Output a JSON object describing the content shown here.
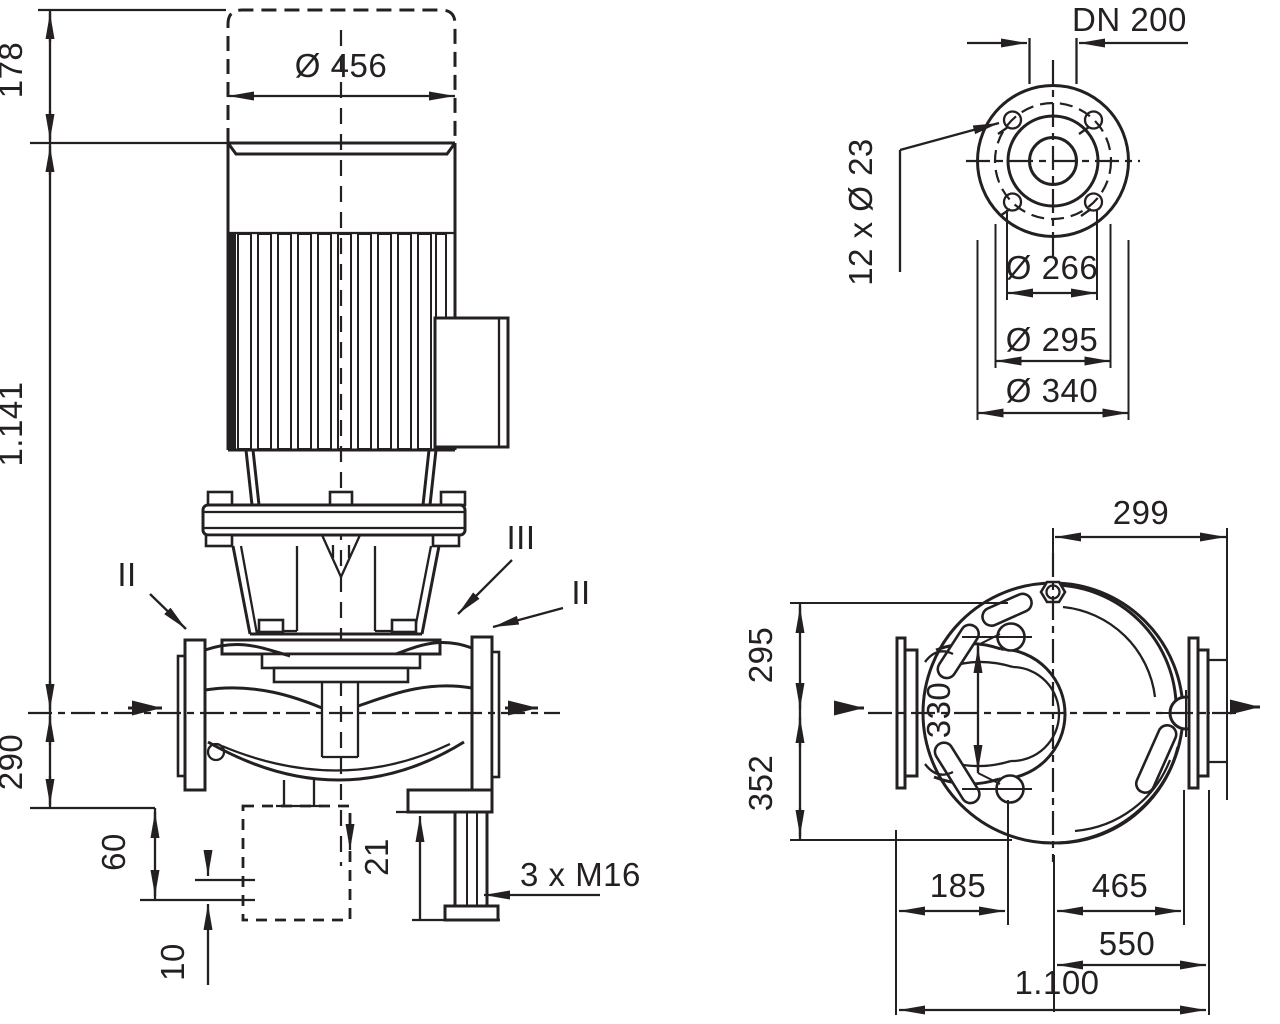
{
  "colors": {
    "background": "#ffffff",
    "ink": "#242021"
  },
  "front_view": {
    "dims": {
      "envelope_height": "178",
      "motor_diameter": "Ø 456",
      "total_height": "1.141",
      "centerline_height": "290",
      "foot_height": "60",
      "base_height": "10",
      "pad_height": "21",
      "foot_thread": "3 x M16"
    },
    "sections": {
      "left": "II",
      "top": "III",
      "right": "II"
    }
  },
  "flange_view": {
    "nominal_diameter": "DN 200",
    "bolt_holes": "12 x Ø 23",
    "raised_face_diameter": "Ø 266",
    "bolt_circle_diameter": "Ø 295",
    "flange_outer_diameter": "Ø 340"
  },
  "plan_view": {
    "center_to_flange_edge": "299",
    "center_to_top": "295",
    "bolt_spacing": "330",
    "center_to_bottom": "352",
    "foot_offset_left": "185",
    "foot_offset_right": "465",
    "center_to_flange_face": "550",
    "total_length": "1.100"
  }
}
